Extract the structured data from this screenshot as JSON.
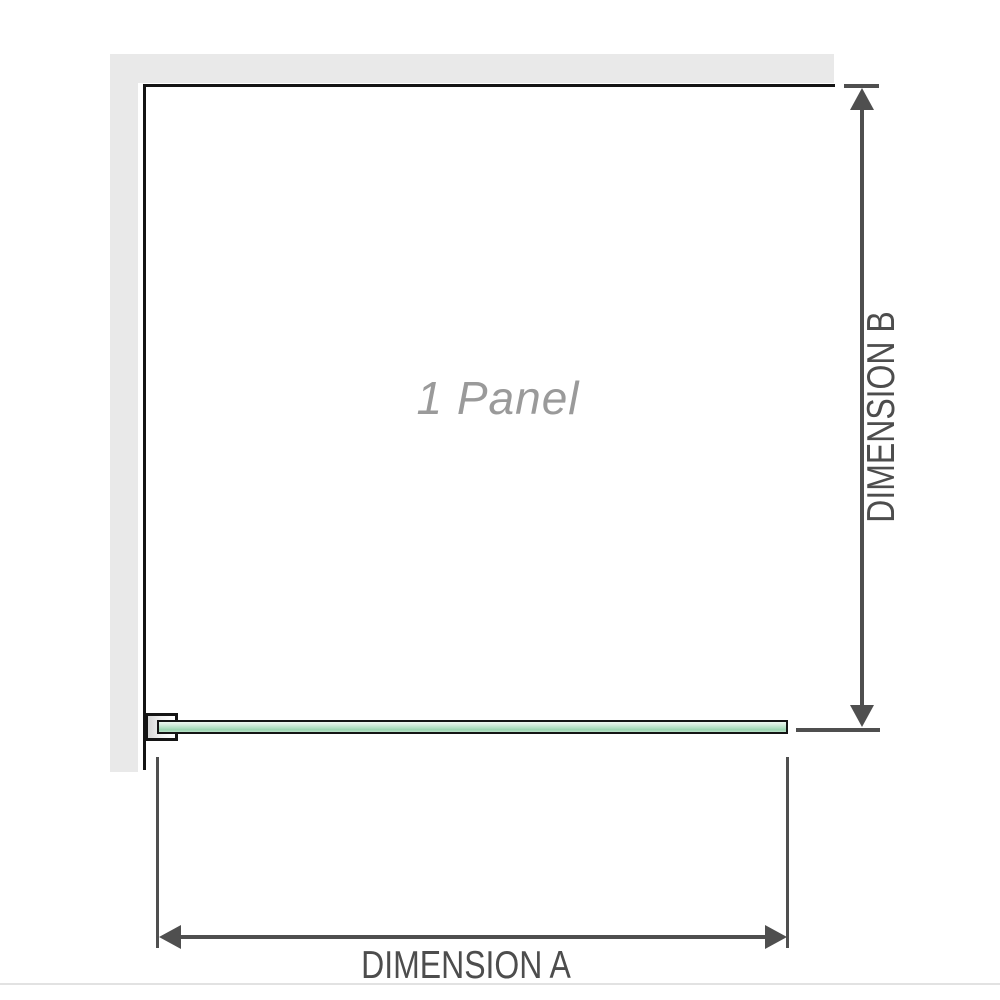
{
  "diagram": {
    "panel_label": "1 Panel",
    "dimension_a_label": "DIMENSION A",
    "dimension_b_label": "DIMENSION B"
  },
  "colors": {
    "background": "#ffffff",
    "wall_fill": "#e9e9e9",
    "outline": "#141414",
    "dimension_line": "#4f4f4f",
    "dimension_text": "#4d4d4d",
    "watermark_text": "#9a9a9a",
    "glass_green_light": "#edf7f0",
    "glass_green_dark": "#9bd4b0",
    "divider": "#e2e2e2"
  }
}
